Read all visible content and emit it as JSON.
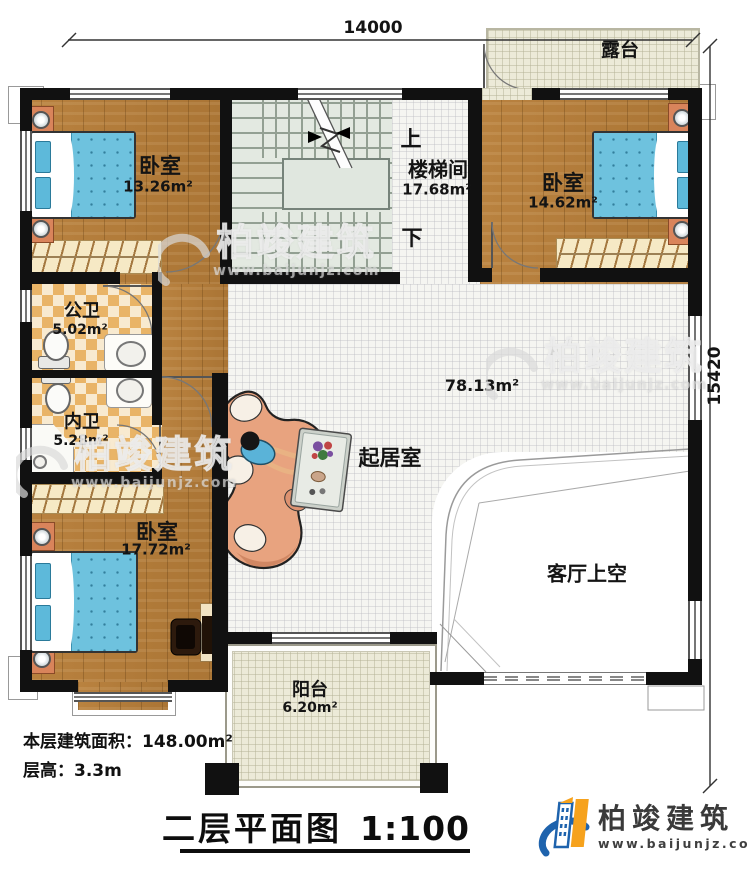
{
  "dims": {
    "width": "14000",
    "height": "15420"
  },
  "rooms": {
    "bedroom_top_left": {
      "name": "卧室",
      "area": "13.26m²"
    },
    "stairwell": {
      "name": "楼梯间",
      "area": "17.68m²",
      "up_label": "上",
      "down_label": "下"
    },
    "bedroom_top_right": {
      "name": "卧室",
      "area": "14.62m²"
    },
    "terrace": {
      "name": "露台"
    },
    "public_bath": {
      "name": "公卫",
      "area": "5.02m²"
    },
    "private_bath": {
      "name": "内卫",
      "area": "5.28m²"
    },
    "bedroom_bottom_left": {
      "name": "卧室",
      "area": "17.72m²"
    },
    "living_room": {
      "name": "起居室",
      "area": "78.13m²"
    },
    "living_void": {
      "name": "客厅上空"
    },
    "balcony": {
      "name": "阳台",
      "area": "6.20m²"
    }
  },
  "notes": {
    "floor_area": "本层建筑面积：148.00m²",
    "floor_height": "层高：3.3m"
  },
  "title": {
    "text": "二层平面图",
    "scale": "1:100"
  },
  "brand": {
    "name": "柏竣建筑",
    "url": "www.baijunjz.com"
  },
  "watermark": {
    "name": "柏竣建筑",
    "url": "www.baijunjz.com"
  },
  "colors": {
    "wall": "#111111",
    "wood": "#b07a3a",
    "tile_light": "#f5f5f1",
    "tile_warm": "#ecead8",
    "checker": "#e9b467",
    "stairs": "#e3e9e1",
    "bed_blue": "#6ec2de",
    "sofa": "#e8a37f",
    "logo_blue": "#1e63ad",
    "logo_orange": "#f6a21d"
  }
}
